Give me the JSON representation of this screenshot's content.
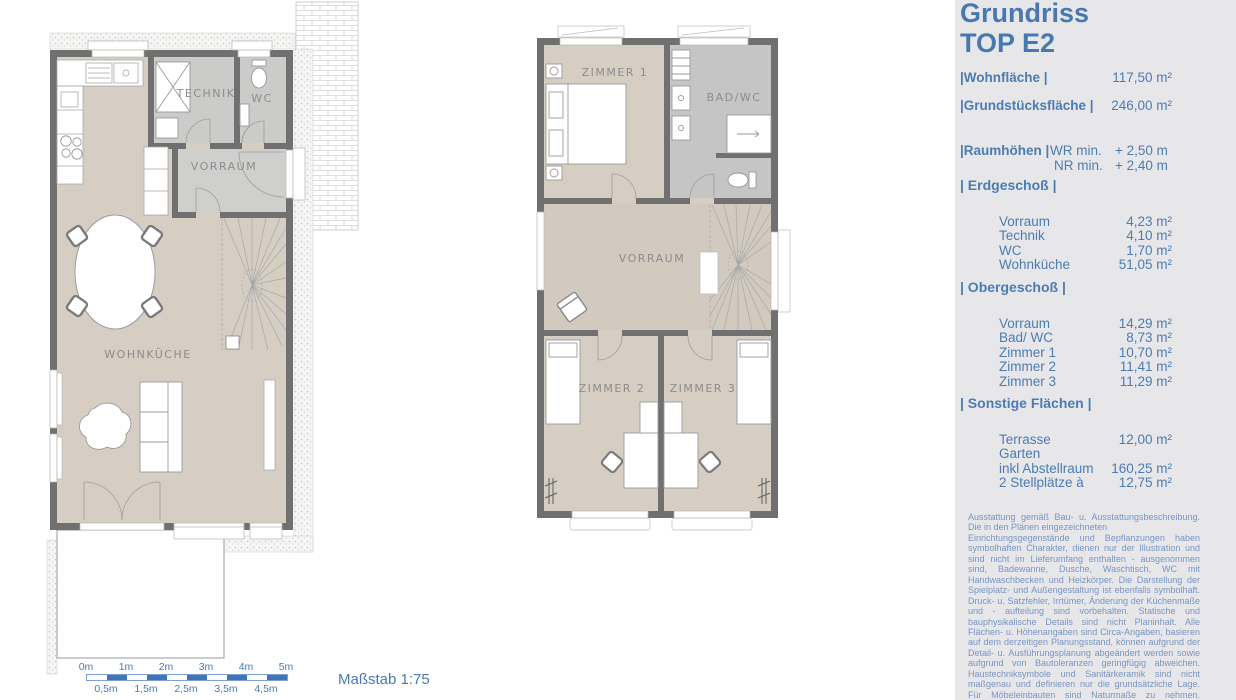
{
  "panel": {
    "title_line1": "Grundriss",
    "title_line2": "TOP E2",
    "summary": [
      {
        "label": "|Wohnfläche |",
        "value": "117,50 m²"
      },
      {
        "label": "|Grundstücksfläche |",
        "value": "246,00 m²"
      }
    ],
    "raumhoehen": {
      "label": "|Raumhöhen |",
      "rows": [
        {
          "key": "WR min.",
          "value": "+ 2,50 m"
        },
        {
          "key": "NR  min.",
          "value": "+ 2,40 m"
        }
      ]
    },
    "sections": [
      {
        "heading": "| Erdgeschoß |",
        "rows": [
          [
            "Vorraum",
            "4,23 m²"
          ],
          [
            "Technik",
            "4,10 m²"
          ],
          [
            "WC",
            "1,70 m²"
          ],
          [
            "Wohnküche",
            "51,05 m²"
          ]
        ]
      },
      {
        "heading": "| Obergeschoß |",
        "rows": [
          [
            "Vorraum",
            "14,29 m²"
          ],
          [
            "Bad/ WC",
            "8,73 m²"
          ],
          [
            "Zimmer 1",
            "10,70 m²"
          ],
          [
            "Zimmer 2",
            "11,41 m²"
          ],
          [
            "Zimmer 3",
            "11,29 m²"
          ]
        ]
      },
      {
        "heading": "| Sonstige Flächen |",
        "rows": [
          [
            "Terrasse",
            "12,00  m²"
          ],
          [
            "Garten",
            ""
          ],
          [
            "inkl Abstellraum",
            "160,25 m²"
          ],
          [
            "2 Stellplätze à",
            "12,75 m²"
          ]
        ]
      }
    ],
    "disclaimer_1": "Ausstattung gemäß Bau- u. Ausstattungsbeschreibung. Die in den Plänen eingezeichneten",
    "disclaimer_2": "Einrichtungsgegenstände und Bepflanzungen haben symbolhaften Charakter, dienen nur der Illustration und sind nicht im Lieferumfang enthalten - ausgenommen sind, Badewanne, Dusche, Waschtisch, WC mit Handwaschbecken und Heizkörper. Die Darstellung der Spielplatz- und Außengestaltung ist ebenfalls symbolhaft. Druck- u. Satzfehler, Irrtümer, Änderung der Küchenmaße und - aufteilung sind vorbehalten. Statische und bauphysikalische Details sind nicht Planinhalt. Alle Flächen- u. Höhenangaben sind Circa-Angaben, basieren auf dem derzeitigen Planungsstand, können aufgrund der Detail- u. Ausführungsplanung abgeändert werden sowie aufgrund von Bautoleranzen geringfügig abweichen. Haustechniksymbole und Sanitärkeramik sind nicht maßgenau und definieren nur die grundsätzliche Lage. Für Möbeleinbauten sind Naturmaße zu nehmen. Maßgeblich ist in jedem Fall der Kaufvertrag."
  },
  "ground_floor": {
    "technik": "TECHNIK",
    "wc": "WC",
    "vorraum": "VORRAUM",
    "wohnkueche": "WOHNKÜCHE"
  },
  "upper_floor": {
    "zimmer1": "ZIMMER 1",
    "bad_wc": "BAD/WC",
    "vorraum": "VORRAUM",
    "zimmer2": "ZIMMER 2",
    "zimmer3": "ZIMMER 3"
  },
  "scalebar": {
    "top_labels": [
      "0m",
      "1m",
      "2m",
      "3m",
      "4m",
      "5m"
    ],
    "bottom_labels": [
      "0,5m",
      "1,5m",
      "2,5m",
      "3,5m",
      "4,5m"
    ],
    "caption": "Maßstab 1:75"
  },
  "colors": {
    "accent_blue": "#4a7ab2",
    "scalebar_blue": "#3d74ba",
    "fineprint_blue": "#7795c2",
    "panel_bg": "#e7e7ea",
    "wall_gray": "#707070",
    "floor_beige": "#d6cec3",
    "room_gray": "#cbcbca",
    "bath_gray": "#c5c5c5"
  }
}
